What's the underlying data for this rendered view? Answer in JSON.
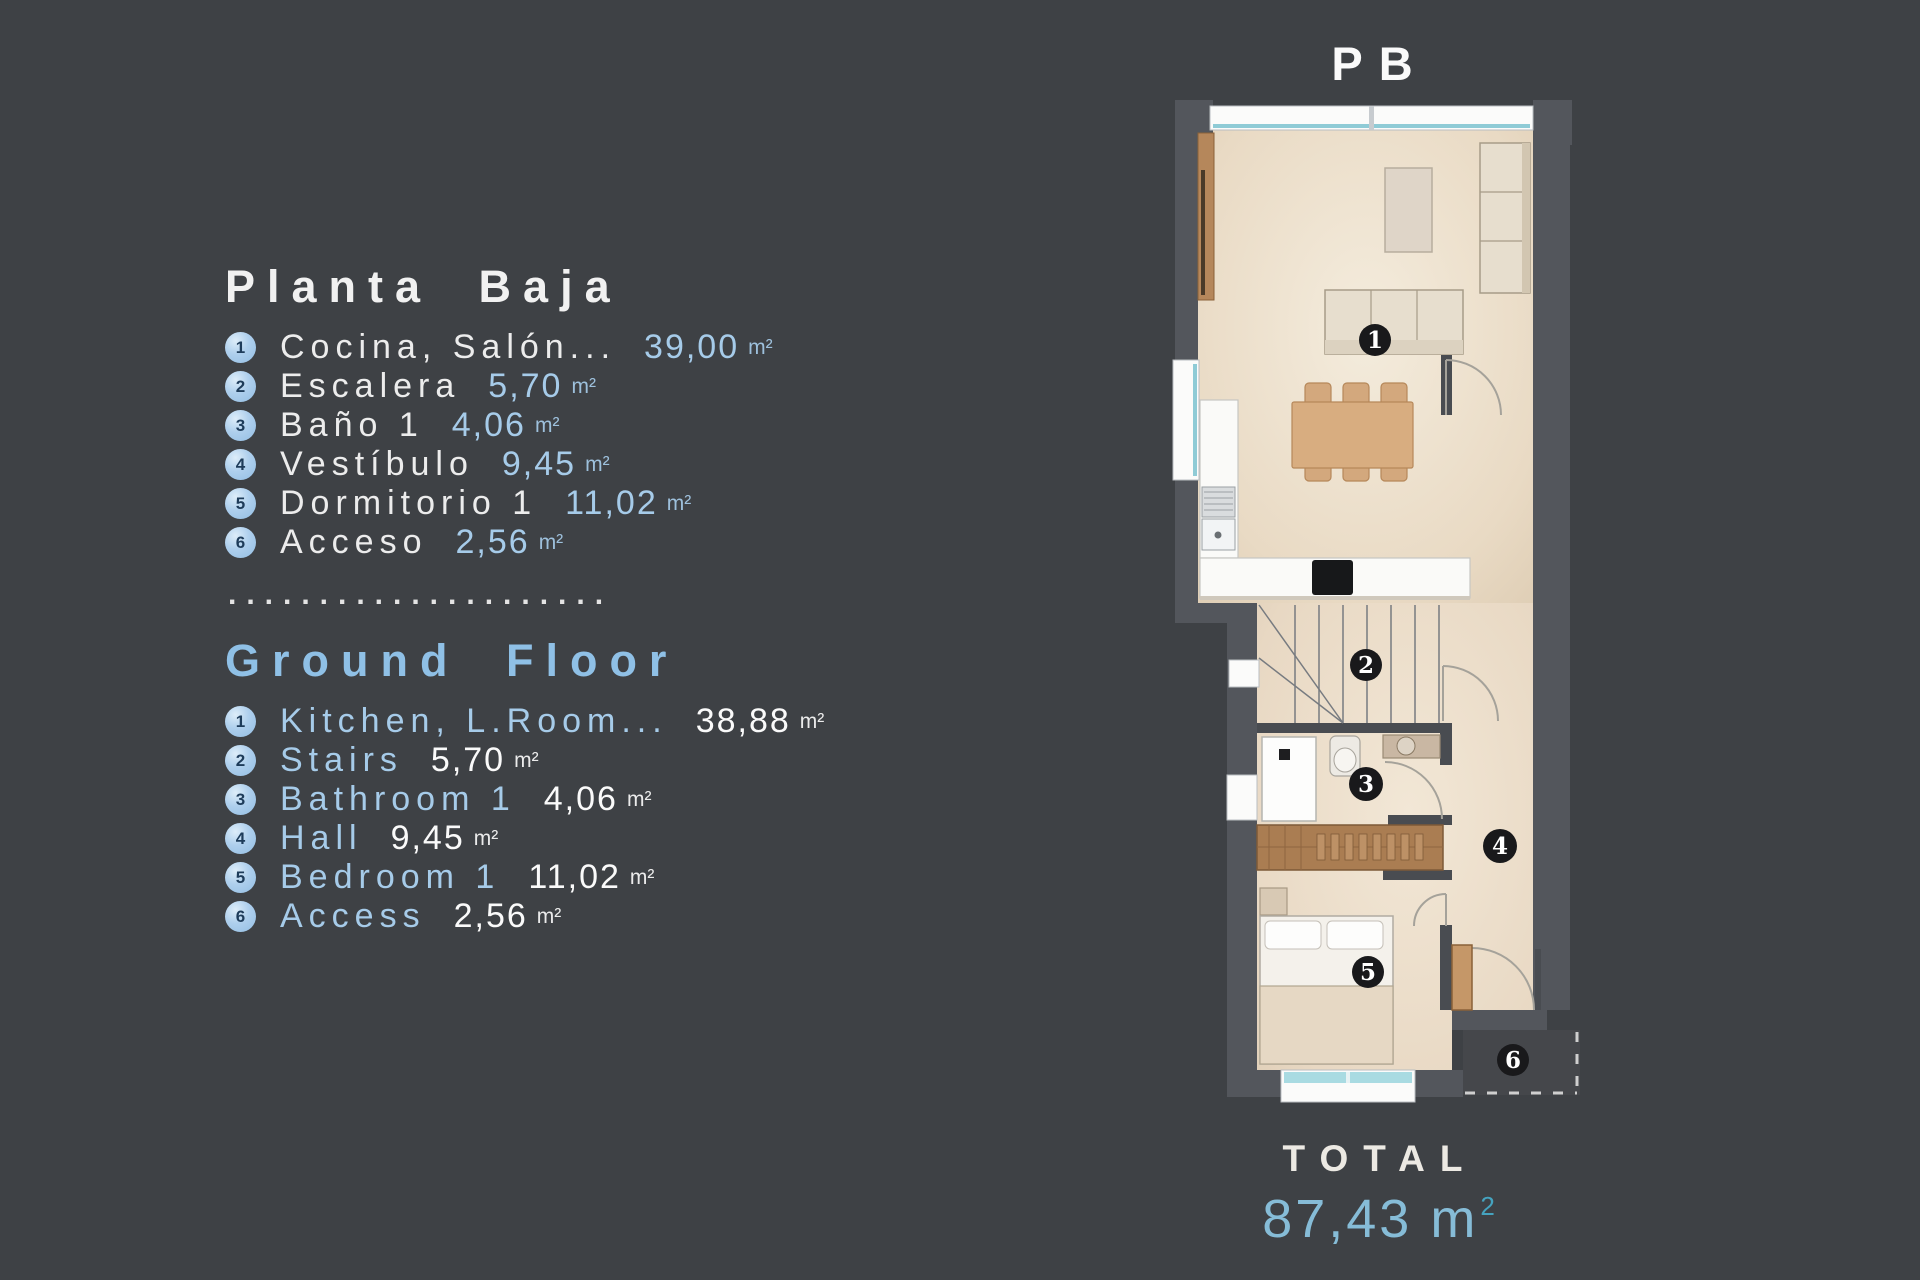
{
  "colors": {
    "background": "#3E4145",
    "wall": "#53565C",
    "floor": "#EBDECA",
    "accent_blue": "#A6CBE9",
    "heading_blue": "#8FC0E6",
    "total_value_color": "#86BCD7",
    "marker_bg": "#19191B"
  },
  "legend_es": {
    "title": "Planta Baja",
    "items": [
      {
        "num": "1",
        "label": "Cocina, Salón...",
        "value": "39,00",
        "unit": "m²"
      },
      {
        "num": "2",
        "label": "Escalera",
        "value": "5,70",
        "unit": "m²"
      },
      {
        "num": "3",
        "label": "Baño 1",
        "value": "4,06",
        "unit": "m²"
      },
      {
        "num": "4",
        "label": "Vestíbulo",
        "value": "9,45",
        "unit": "m²"
      },
      {
        "num": "5",
        "label": "Dormitorio 1",
        "value": "11,02",
        "unit": "m²"
      },
      {
        "num": "6",
        "label": "Acceso",
        "value": "2,56",
        "unit": "m²"
      }
    ]
  },
  "separator": {
    "dots": "....................."
  },
  "legend_en": {
    "title": "Ground Floor",
    "items": [
      {
        "num": "1",
        "label": "Kitchen, L.Room...",
        "value": "38,88",
        "unit": "m²"
      },
      {
        "num": "2",
        "label": "Stairs",
        "value": "5,70",
        "unit": "m²"
      },
      {
        "num": "3",
        "label": "Bathroom 1",
        "value": "4,06",
        "unit": "m²"
      },
      {
        "num": "4",
        "label": "Hall",
        "value": "9,45",
        "unit": "m²"
      },
      {
        "num": "5",
        "label": "Bedroom 1",
        "value": "11,02",
        "unit": "m²"
      },
      {
        "num": "6",
        "label": "Access",
        "value": "2,56",
        "unit": "m²"
      }
    ]
  },
  "plan": {
    "title": "PB",
    "markers": [
      "1",
      "2",
      "3",
      "4",
      "5",
      "6"
    ],
    "total": {
      "label": "TOTAL",
      "value": "87,43 m",
      "sup": "2"
    }
  }
}
